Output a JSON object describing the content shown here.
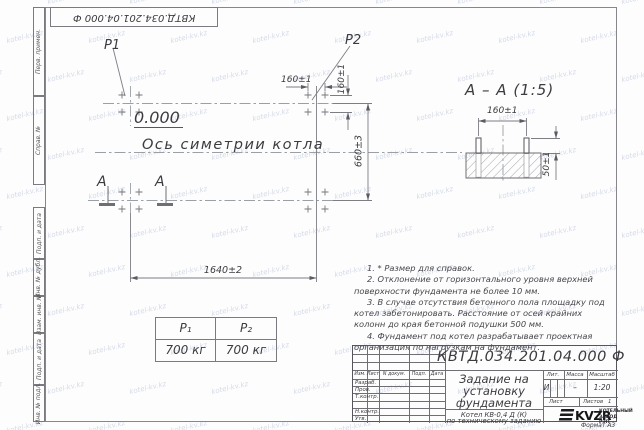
{
  "watermark": "kotel-kv.kz",
  "frame": {
    "doc_number_top": "КВТД.034.201.04.000  Ф",
    "format_label": "Формат А3"
  },
  "margin_labels": {
    "perv_primen": "Перв. примен.",
    "sprav_n": "Справ. №",
    "podp_data_1": "Подп. и дата",
    "inv_dubl": "Инв. № дубл.",
    "vzam_inv": "Взам. инв. №",
    "podp_data_2": "Подп. и дата",
    "inv_podl": "Инв. № подл."
  },
  "plan": {
    "p1": "P1",
    "p2": "P2",
    "level": "0.000",
    "axis": "Ось симетрии котла",
    "section_letter_left": "А",
    "section_letter_right": "А",
    "dim_bolt_h": "160±1",
    "dim_bolt_v": "160±1",
    "dim_height": "660±3",
    "dim_width": "1640±2"
  },
  "detail": {
    "title": "А – А (1:5)",
    "dim_spacing": "160±1",
    "dim_protrusion": "50±1"
  },
  "loads": {
    "col1_header": "P₁",
    "col2_header": "P₂",
    "col1_value": "700 кг",
    "col2_value": "700 кг"
  },
  "notes": [
    "1. * Размер для справок.",
    "2. Отклонение от горизонтального уровня верхней поверхности фундамента не более 10 мм.",
    "3. В случае отсутствия бетонного пола площадку под котел забетонировать. Расстояние от осей крайних колонн до края бетонной подушки 500 мм.",
    "4. Фундамент под котел разрабатывает проектная организация по нагрузкам на фундамент."
  ],
  "title_block": {
    "doc_number": "КВТД.034.201.04.000  Ф",
    "title_line1": "Задание на",
    "title_line2": "установку",
    "title_line3": "фундамента",
    "subtitle_line1": "Котел  КВ-0,4  Д  (К)",
    "subtitle_line2": "по техническому заданию",
    "col_izm": "Изм.",
    "col_list": "Лист",
    "col_ndoc": "N докум.",
    "col_podp": "Подп.",
    "col_data": "Дата",
    "row_razrab": "Разраб.",
    "row_prov": "Пров.",
    "row_tkontr": "Т.контр.",
    "row_nkontr": "Н.контр.",
    "row_utv": "Утв.",
    "lit_header": "Лит.",
    "mass_header": "Масса",
    "scale_header": "Масштаб",
    "lit_value": "И",
    "mass_value": "–",
    "scale_value": "1:20",
    "list_label": "Лист",
    "listov_label": "Листов",
    "listov_value": "1",
    "logo": "KVZR",
    "org_line1": "КОТЕЛЬНЫЙ",
    "org_line2": "ЗАВОД РЭП"
  }
}
